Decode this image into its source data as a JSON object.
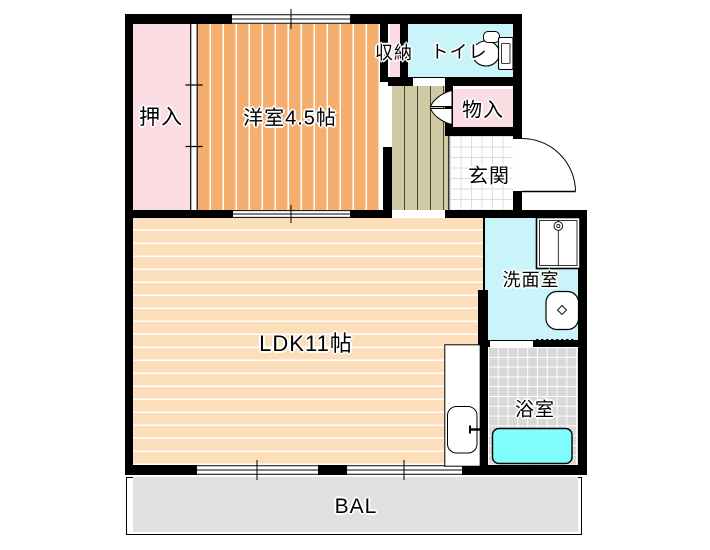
{
  "plan": {
    "type": "apartment-floor-plan",
    "labels": {
      "oshiire": "押入",
      "yoshitsu": "洋室4.5帖",
      "shuno": "収納",
      "toire": "トイレ",
      "monoire": "物入",
      "genkan": "玄関",
      "senmen": "洗面室",
      "ldk": "LDK11帖",
      "yokushitsu": "浴室",
      "balcony": "BAL"
    },
    "colors": {
      "wall": "#000000",
      "closet_pink": "#FBDCE2",
      "room_orange": "#F5AE6E",
      "ldk_peach": "#FCDEBB",
      "hallway_khaki": "#CFCAA3",
      "hallway_line": "#44442F",
      "water_cyan": "#C9F4FA",
      "tub_cyan": "#80FCFC",
      "bath_tile_gray": "#D8D8D8",
      "balcony_gray": "#E0E0E0",
      "genkan_grid": "#DCDCDC",
      "stripe_white": "#FFFFFF"
    }
  }
}
